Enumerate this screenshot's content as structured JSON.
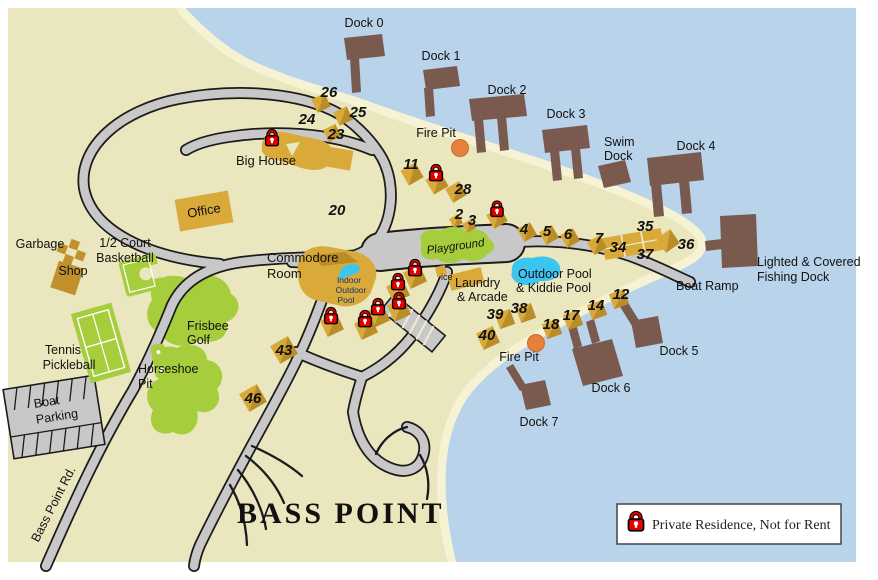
{
  "map": {
    "title": "BASS POINT",
    "road_name": "Bass Point Rd.",
    "legend": {
      "text": "Private Residence, Not for Rent"
    },
    "docks": {
      "d0": "Dock 0",
      "d1": "Dock 1",
      "d2": "Dock 2",
      "d3": "Dock 3",
      "d4": "Dock 4",
      "d5": "Dock 5",
      "d6": "Dock 6",
      "d7": "Dock 7",
      "swim": [
        "Swim",
        "Dock"
      ],
      "fishing": [
        "Lighted & Covered",
        "Fishing Dock"
      ],
      "boat_ramp": "Boat Ramp"
    },
    "amenities": {
      "fire_pit": "Fire Pit",
      "big_house": "Big House",
      "office": "Office",
      "garbage": "Garbage",
      "shop": "Shop",
      "basketball": [
        "1/2 Court",
        "Basketball"
      ],
      "tennis": [
        "Tennis",
        "Pickleball"
      ],
      "horseshoe": [
        "Horseshoe",
        "Pit"
      ],
      "frisbee": [
        "Frisbee",
        "Golf"
      ],
      "boat_parking": [
        "Boat",
        "Parking"
      ],
      "commodore": [
        "Commodore",
        "Room"
      ],
      "indoor_pool": [
        "Indoor",
        "Outdoor",
        "Pool"
      ],
      "playground": "Playground",
      "ice": "ice",
      "laundry": [
        "Laundry",
        "& Arcade"
      ],
      "outdoor_pool": [
        "Outdoor Pool",
        "& Kiddie Pool"
      ]
    },
    "sites": {
      "s2": "2",
      "s3": "3",
      "s4": "4",
      "s5": "5",
      "s6": "6",
      "s7": "7",
      "s11": "11",
      "s12": "12",
      "s14": "14",
      "s17": "17",
      "s18": "18",
      "s20": "20",
      "s23": "23",
      "s24": "24",
      "s25": "25",
      "s26": "26",
      "s28": "28",
      "s34": "34",
      "s35": "35",
      "s36": "36",
      "s37": "37",
      "s38": "38",
      "s39": "39",
      "s40": "40",
      "s43": "43",
      "s46": "46"
    },
    "colors": {
      "water": "#b9d3ea",
      "land": "#eae6bd",
      "beach": "#f6f2d4",
      "road": "#c8c8c8",
      "casing": "#1b1b1b",
      "dock": "#7a5a4e",
      "gold": "#d9aa3a",
      "gold2": "#bb8d26",
      "brown": "#c0912d",
      "green": "#a6ce3c",
      "pool": "#3cc6ef",
      "fire": "#e5813c",
      "lockred": "#e60000"
    }
  }
}
